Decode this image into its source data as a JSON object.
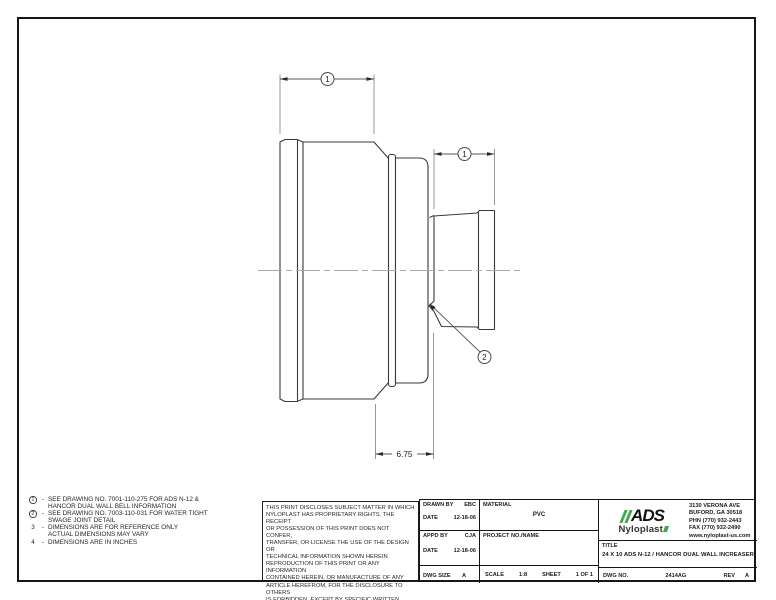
{
  "colors": {
    "accent_green": "#3fa94d",
    "line": "#2e2e2e"
  },
  "drawing": {
    "balloon_bell": "1",
    "balloon_pipe": "1",
    "balloon_swage": "2",
    "length_dim": "6.75"
  },
  "notes": [
    {
      "marker": "1",
      "sep": "-",
      "line1": "SEE DRAWING NO. 7001-110-275 FOR ADS N-12 &",
      "line2": "HANCOR DUAL WALL BELL INFORMATION"
    },
    {
      "marker": "2",
      "sep": "-",
      "line1": "SEE DRAWING NO. 7003-110-031 FOR WATER TIGHT",
      "line2": "SWAGE JOINT DETAIL"
    },
    {
      "marker": "3",
      "sep": "-",
      "line1": "DIMENSIONS ARE FOR REFERENCE ONLY",
      "line2": "ACTUAL DIMENSIONS MAY VARY"
    },
    {
      "marker": "4",
      "sep": "-",
      "line1": "DIMENSIONS ARE IN INCHES",
      "line2": ""
    }
  ],
  "disclaimer": [
    "THIS PRINT DISCLOSES SUBJECT MATTER IN WHICH",
    "NYLOPLAST HAS PROPRIETARY RIGHTS.  THE RECEIPT",
    "OR POSSESSION OF THIS PRINT DOES NOT CONFER,",
    "TRANSFER, OR LICENSE THE USE OF THE DESIGN OR",
    "TECHNICAL INFORMATION SHOWN HEREIN",
    "REPRODUCTION OF THIS PRINT OR ANY INFORMATION",
    "CONTAINED HEREIN, OR MANUFACTURE OF ANY",
    "ARTICLE HEREFROM, FOR THE DISCLOSURE TO OTHERS",
    "IS FORBIDDEN, EXCEPT BY SPECIFIC WRITTEN",
    "PERMISSION FROM NYLOPLAST."
  ],
  "title_block": {
    "drawn_by_label": "DRAWN BY",
    "drawn_by": "EBC",
    "drawn_date_label": "DATE",
    "drawn_date": "12-18-06",
    "material_label": "MATERIAL",
    "material": "PVC",
    "appd_by_label": "APPD BY",
    "appd_by": "CJA",
    "appd_date_label": "DATE",
    "appd_date": "12-18-06",
    "project_label": "PROJECT NO./NAME",
    "project": "",
    "dwg_size_label": "DWG SIZE",
    "dwg_size": "A",
    "scale_label": "SCALE",
    "scale": "1:8",
    "sheet_label": "SHEET",
    "sheet": "1 OF 1",
    "title_label": "TITLE",
    "title": "24 X 10 ADS N-12 / HANCOR DUAL WALL INCREASER",
    "dwg_no_label": "DWG NO.",
    "dwg_no": "2414AG",
    "rev_label": "REV",
    "rev": "A"
  },
  "company": {
    "logo_text": "ADS",
    "logo_sub": "Nyloplast",
    "address": [
      "3130 VERONA AVE",
      "BUFORD, GA 30518",
      "PHN (770) 932-2443",
      "FAX (770) 932-2490",
      "www.nyloplast-us.com"
    ]
  }
}
